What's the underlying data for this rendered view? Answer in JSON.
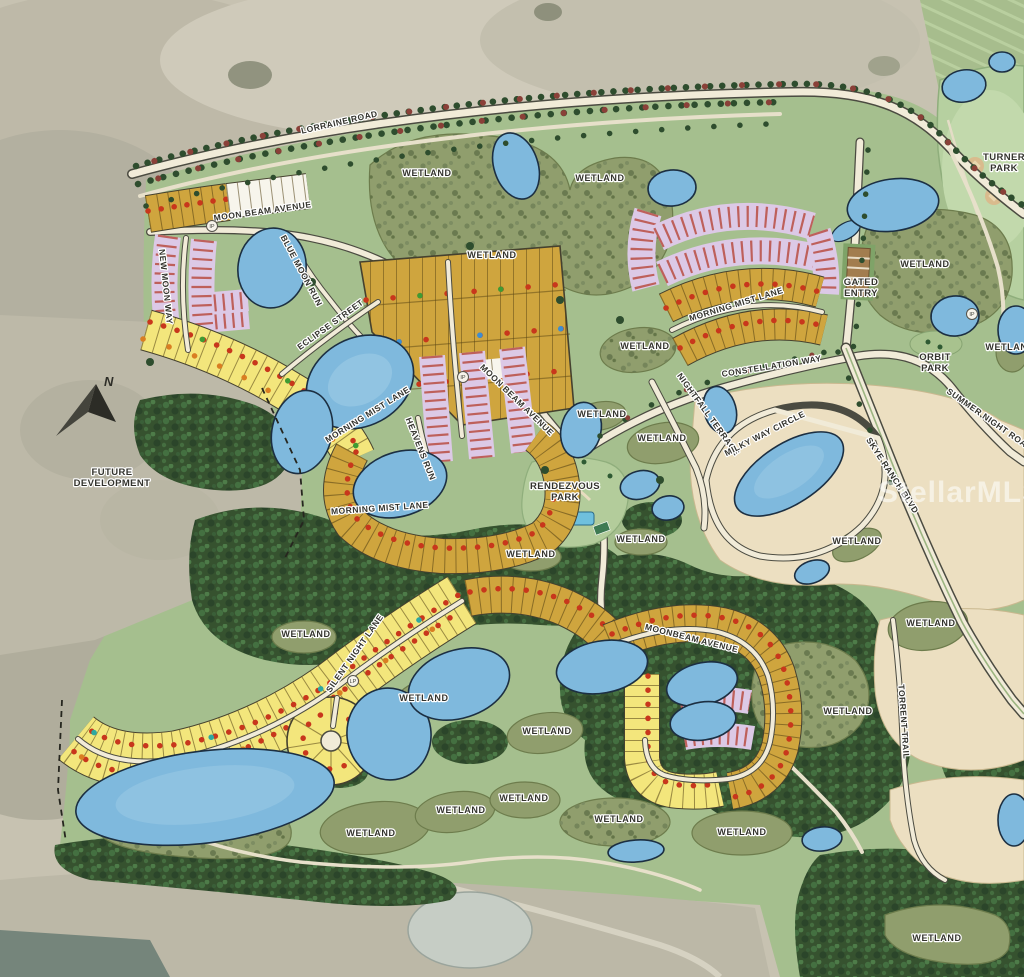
{
  "map": {
    "description": "Master site plan of a residential community with lot clusters, wetlands, ponds, parks and street network over an aerial photo",
    "watermark": "StellarMLS",
    "north_label": "N"
  },
  "labels": {
    "streets": [
      {
        "t": "LORRAINE ROAD",
        "x": 340,
        "y": 125,
        "r": -13
      },
      {
        "t": "MOON BEAM AVENUE",
        "x": 263,
        "y": 214,
        "r": -8
      },
      {
        "t": "NEW MOON WAY",
        "x": 163,
        "y": 287,
        "r": 84
      },
      {
        "t": "BLUE MOON RUN",
        "x": 299,
        "y": 272,
        "r": 62
      },
      {
        "t": "ECLIPSE STREET",
        "x": 332,
        "y": 327,
        "r": -36
      },
      {
        "t": "MORNING MIST LANE",
        "x": 369,
        "y": 417,
        "r": -32
      },
      {
        "t": "HEAVENS RUN",
        "x": 418,
        "y": 450,
        "r": 68
      },
      {
        "t": "MORNING MIST LANE",
        "x": 380,
        "y": 511,
        "r": -4
      },
      {
        "t": "MOON BEAM AVENUE",
        "x": 515,
        "y": 402,
        "r": 44
      },
      {
        "t": "MORNING MIST LANE",
        "x": 737,
        "y": 307,
        "r": -17
      },
      {
        "t": "CONSTELLATION WAY",
        "x": 772,
        "y": 369,
        "r": -9
      },
      {
        "t": "NIGHTFALL TERRACE",
        "x": 706,
        "y": 416,
        "r": 54
      },
      {
        "t": "MILKY WAY CIRCLE",
        "x": 766,
        "y": 436,
        "r": -27
      },
      {
        "t": "SUMMER NIGHT ROAD",
        "x": 988,
        "y": 422,
        "r": 35
      },
      {
        "t": "SKYE RANCH BLVD",
        "x": 890,
        "y": 477,
        "r": 57
      },
      {
        "t": "SILENT NIGHT LANE",
        "x": 357,
        "y": 655,
        "r": -55
      },
      {
        "t": "MOONBEAM AVENUE",
        "x": 691,
        "y": 641,
        "r": 14
      },
      {
        "t": "TORRENT TRAIL",
        "x": 901,
        "y": 722,
        "r": 86
      }
    ],
    "places": [
      {
        "lines": [
          "TURNER",
          "PARK"
        ],
        "x": 1004,
        "y": 160
      },
      {
        "lines": [
          "GATED",
          "ENTRY"
        ],
        "x": 861,
        "y": 285
      },
      {
        "lines": [
          "ORBIT",
          "PARK"
        ],
        "x": 935,
        "y": 360
      },
      {
        "lines": [
          "RENDEZVOUS",
          "PARK"
        ],
        "x": 565,
        "y": 489
      },
      {
        "lines": [
          "FUTURE",
          "DEVELOPMENT"
        ],
        "x": 112,
        "y": 475
      }
    ],
    "wetland_text": "WETLAND",
    "wetlands": [
      [
        427,
        176
      ],
      [
        600,
        181
      ],
      [
        492,
        258
      ],
      [
        925,
        267
      ],
      [
        1010,
        350
      ],
      [
        645,
        349
      ],
      [
        602,
        417
      ],
      [
        662,
        441
      ],
      [
        531,
        557
      ],
      [
        641,
        542
      ],
      [
        857,
        544
      ],
      [
        306,
        637
      ],
      [
        424,
        701
      ],
      [
        547,
        734
      ],
      [
        931,
        626
      ],
      [
        848,
        714
      ],
      [
        371,
        836
      ],
      [
        461,
        813
      ],
      [
        524,
        801
      ],
      [
        619,
        822
      ],
      [
        742,
        835
      ],
      [
        937,
        941
      ]
    ],
    "markers": [
      {
        "t": "IP",
        "x": 212,
        "y": 226
      },
      {
        "t": "IP",
        "x": 972,
        "y": 314
      },
      {
        "t": "IP",
        "x": 463,
        "y": 377
      },
      {
        "t": "LP",
        "x": 353,
        "y": 681
      }
    ],
    "north": "N",
    "watermark": "StellarMLS"
  },
  "palette": {
    "lot_yellow": "#f3e67c",
    "lot_gold": "#cfa53e",
    "lot_lavender": "#dcc9e6",
    "lot_white": "#f7f5ec",
    "parcel_cream": "#ecdfc1",
    "dot_red": "#c8371c",
    "dot_orange": "#d97e22",
    "dot_green": "#3f9b33",
    "dot_blue": "#3e8ed0",
    "dot_teal": "#2fa8a0",
    "water": "#7fb9dd",
    "road": "#f1ebd8",
    "wetland_olive": "#909e6d",
    "forest_green": "#36522f",
    "plan_green": "#a5bf8e",
    "aerial_tan": "#c7c2b1"
  }
}
